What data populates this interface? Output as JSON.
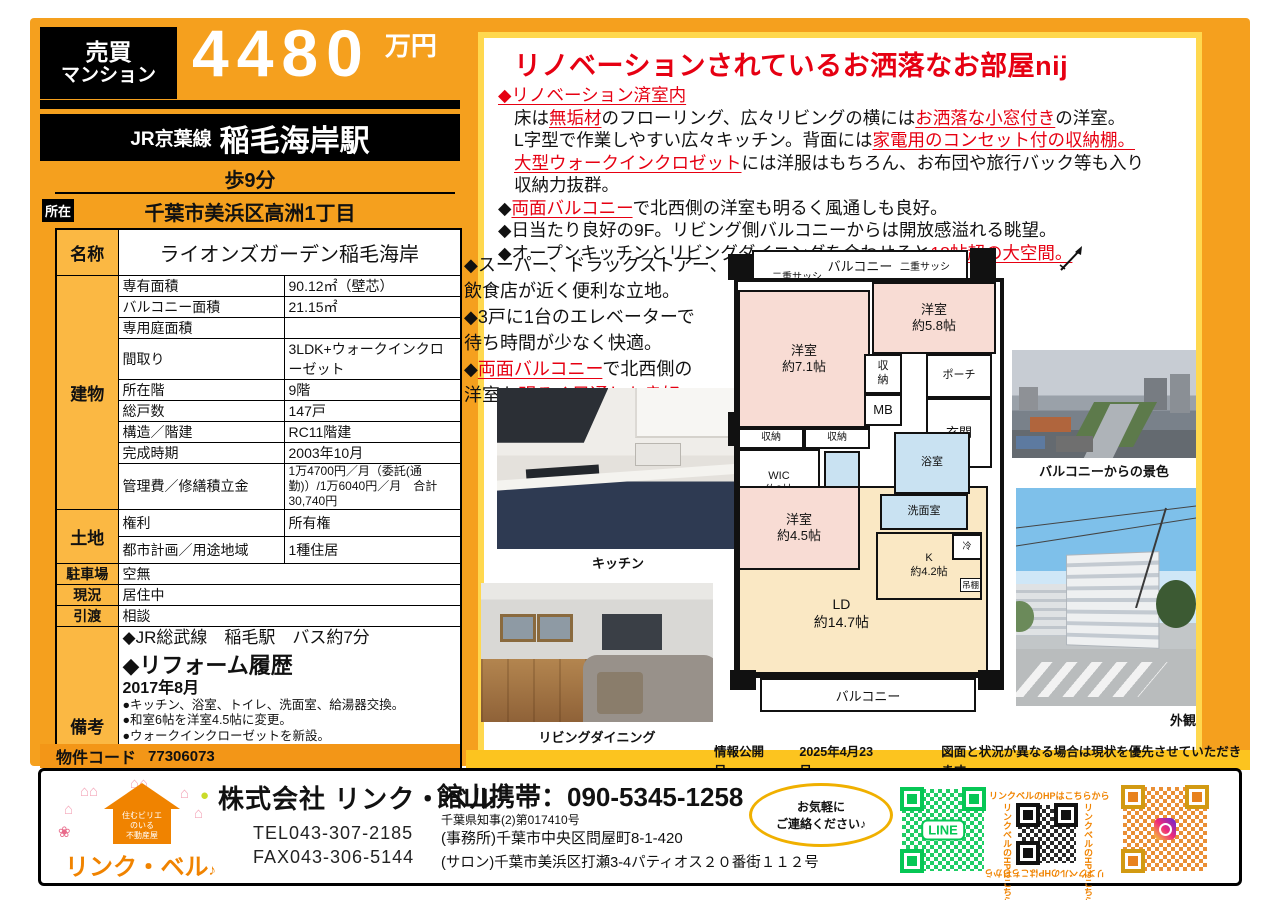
{
  "colors": {
    "orange_bg": "#F5A01E",
    "gold_strip": "#FCC41F",
    "panel_border": "#FFD84E",
    "label_cell": "#FBB843",
    "accent_red": "#E60012",
    "line_green": "#06C755",
    "insta_orange": "#E8821E",
    "room_pink": "#F8DCD4",
    "room_cream": "#FAE8C4",
    "room_blue": "#C9E2F2"
  },
  "price": {
    "category_line1": "売買",
    "category_line2": "マンション",
    "amount": "4480",
    "unit": "万円"
  },
  "access": {
    "line": "JR京葉線",
    "station": "稲毛海岸駅",
    "walk": "歩9分",
    "location_label": "所在",
    "address": "千葉市美浜区高洲1丁目"
  },
  "spec_table": {
    "name_label": "名称",
    "name_value": "ライオンズガーデン稲毛海岸",
    "building_label": "建物",
    "building_rows": [
      {
        "label": "専有面積",
        "value": "90.12㎡（壁芯）"
      },
      {
        "label": "バルコニー面積",
        "value": "21.15㎡"
      },
      {
        "label": "専用庭面積",
        "value": ""
      },
      {
        "label": "間取り",
        "value": "3LDK+ウォークインクローゼット"
      },
      {
        "label": "所在階",
        "value": "9階"
      },
      {
        "label": "総戸数",
        "value": "147戸"
      },
      {
        "label": "構造／階建",
        "value": "RC11階建"
      },
      {
        "label": "完成時期",
        "value": "2003年10月"
      },
      {
        "label": "管理費／修繕積立金",
        "value": "1万4700円／月（委託(通勤)）/1万6040円／月　合計30,740円"
      }
    ],
    "land_label": "土地",
    "land_rows": [
      {
        "label": "権利",
        "value": "所有権"
      },
      {
        "label": "都市計画／用途地域",
        "value": "1種住居"
      }
    ],
    "simple_rows": [
      {
        "label": "駐車場",
        "value": "空無"
      },
      {
        "label": "現況",
        "value": "居住中"
      },
      {
        "label": "引渡",
        "value": "相談"
      }
    ],
    "remarks_label": "備考",
    "remarks_lines": [
      "◆JR総武線　稲毛駅　バス約7分",
      "",
      "◆リフォーム履歴",
      "2017年8月",
      "●キッチン、浴室、トイレ、洗面室、給湯器交換。",
      "●和室6帖を洋室4.5帖に変更。",
      "●ウォークインクローゼットを新設。",
      "2022年10月",
      "●LDと洋室4．5帖の床を無垢のフローリングに。",
      "●壁クロス全室張替え。",
      "●床CF張替え(トイレ)。",
      "●LD横の洋室をお洒落な小窓付きに変更。"
    ]
  },
  "property_code": {
    "label": "物件コード",
    "value": "77306073"
  },
  "promo": {
    "headline": "リノベーションされているお洒落なお部屋nij",
    "lines": [
      [
        {
          "t": "◆リノベーション済室内",
          "c": "ru"
        }
      ],
      [
        {
          "t": "床は"
        },
        {
          "t": "無垢材",
          "c": "ru"
        },
        {
          "t": "のフローリング、広々リビングの横には"
        },
        {
          "t": "お洒落な小窓付き",
          "c": "ru"
        },
        {
          "t": "の洋室。"
        }
      ],
      [
        {
          "t": "L字型で作業しやすい広々キッチン。背面には"
        },
        {
          "t": "家電用のコンセット付の収納棚。",
          "c": "ru"
        }
      ],
      [
        {
          "t": "大型ウォークインクロゼット",
          "c": "ru"
        },
        {
          "t": "には洋服はもちろん、お布団や旅行バック等も入り"
        }
      ],
      [
        {
          "t": "収納力抜群。"
        }
      ],
      [
        {
          "t": "◆"
        },
        {
          "t": "両面バルコニー",
          "c": "ru"
        },
        {
          "t": "で北西側の洋室も明るく風通しも良好。"
        }
      ],
      [
        {
          "t": "◆日当たり良好の9F。リビング側バルコニーからは開放感溢れる眺望。"
        }
      ],
      [
        {
          "t": "◆オープンキッチンとリビングダイニングを合わせると"
        },
        {
          "t": "18帖超の大空間。",
          "c": "ru"
        }
      ]
    ],
    "side_lines": [
      [
        {
          "t": "◆スーパー、ドラックストアー、"
        }
      ],
      [
        {
          "t": "飲食店が近く便利な立地。"
        }
      ],
      [
        {
          "t": "◆3戸に1台のエレベーターで"
        }
      ],
      [
        {
          "t": "待ち時間が少なく快適。"
        }
      ],
      [
        {
          "t": "◆"
        },
        {
          "t": "両面バルコニー",
          "c": "ru"
        },
        {
          "t": "で北西側の"
        }
      ],
      [
        {
          "t": "洋室も"
        },
        {
          "t": "明るく風通しも良好。",
          "c": "ru"
        }
      ]
    ]
  },
  "floorplan": {
    "balcony_top": "バルコニー",
    "sash_left": "二重サッシ",
    "sash_right": "二重サッシ",
    "bedroom71": "洋室\n約7.1帖",
    "bedroom58": "洋室\n約5.8帖",
    "closet_hall": "収\n納",
    "porch": "ポーチ",
    "mb": "MB",
    "entrance": "玄関",
    "closet_a": "収納",
    "closet_b": "収納",
    "closet_wic": "収納",
    "wic": "WIC\n約3帖",
    "bath": "浴室",
    "washroom": "洗面室",
    "bedroom45": "洋室\n約4.5帖",
    "kitchen": "K\n約4.2帖",
    "fridge": "冷",
    "shelf": "吊棚",
    "ld": "LD\n約14.7帖",
    "balcony_bottom": "バルコニー"
  },
  "photos": {
    "kitchen_caption": "キッチン",
    "living_caption": "リビングダイニング",
    "view_caption": "バルコニーからの景色",
    "exterior_caption": "外観"
  },
  "info_strip": {
    "label": "情報公開日",
    "date": "2025年4月23日",
    "note": "図面と状況が異なる場合は現状を優先させていただきます"
  },
  "footer": {
    "logo_name": "リンク・ベル",
    "logo_note": "♪",
    "logo_house": "住むビリエ\nのいる\n不動産屋",
    "company": "株式会社 リンク・ベル",
    "tel": "TEL043-307-2185",
    "fax": "FAX043-306-5144",
    "mobile": "館山携帯：090-5345-1258",
    "license": "千葉県知事(2)第017410号",
    "office": "(事務所)千葉市中央区問屋町8-1-420",
    "salon": "(サロン)千葉市美浜区打瀬3-4パティオス２０番街１１２号",
    "contact": "お気軽に\nご連絡ください♪",
    "line_label": "LINE",
    "hp_text": "リンクベルのHPはこちらから"
  }
}
